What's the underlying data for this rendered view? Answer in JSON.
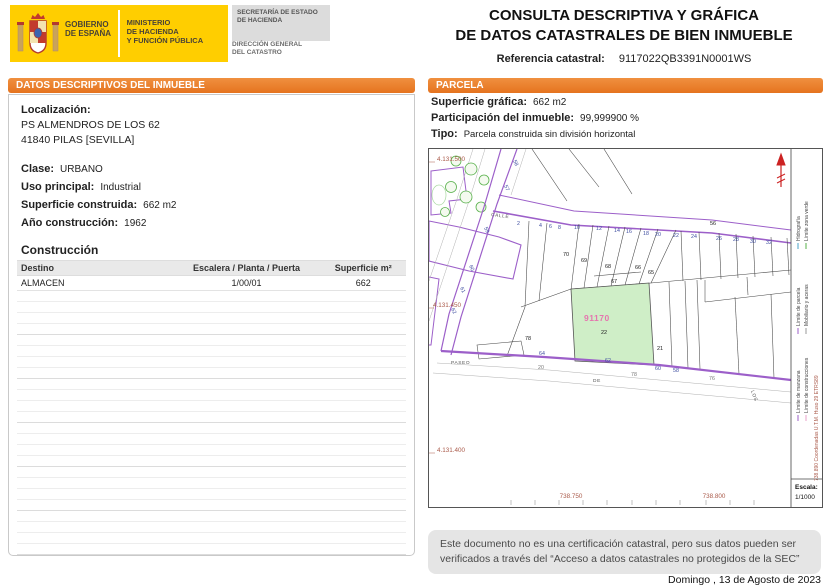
{
  "colors": {
    "banner_orange": "#e5731f",
    "logo_yellow": "#ffce00",
    "map_purple": "#9c5fc9",
    "parcel_green_fill": "#cfeec7",
    "highlight_pink": "#e575ae",
    "geo_red": "#aa5a4a"
  },
  "header": {
    "logo": {
      "gobierno_l1": "GOBIERNO",
      "gobierno_l2": "DE ESPAÑA",
      "ministerio_l1": "MINISTERIO",
      "ministerio_l2": "DE HACIENDA",
      "ministerio_l3": "Y FUNCIÓN PÚBLICA",
      "secretaria_l1": "SECRETARÍA DE ESTADO",
      "secretaria_l2": "DE HACIENDA",
      "direccion_l1": "DIRECCIÓN GENERAL",
      "direccion_l2": "DEL CATASTRO"
    },
    "title_line1": "CONSULTA DESCRIPTIVA Y GRÁFICA",
    "title_line2": "DE DATOS CATASTRALES DE BIEN INMUEBLE",
    "ref_label": "Referencia catastral:",
    "ref_value": "9117022QB3391N0001WS"
  },
  "left_panel": {
    "header": "DATOS DESCRIPTIVOS DEL INMUEBLE",
    "localizacion_label": "Localización:",
    "address_line1": "PS ALMENDROS DE LOS 62",
    "address_line2": "41840 PILAS [SEVILLA]",
    "fields": [
      {
        "label": "Clase:",
        "value": "URBANO"
      },
      {
        "label": "Uso principal:",
        "value": "Industrial"
      },
      {
        "label": "Superficie construida:",
        "value": "662 m2"
      },
      {
        "label": "Año construcción:",
        "value": "1962"
      }
    ],
    "construccion": {
      "title": "Construcción",
      "columns": [
        "Destino",
        "Escalera / Planta / Puerta",
        "Superficie m²"
      ],
      "rows": [
        [
          "ALMACEN",
          "1/00/01",
          "662"
        ]
      ]
    }
  },
  "right_panel": {
    "header": "PARCELA",
    "fields": [
      {
        "label": "Superficie gráfica:",
        "value": "662 m2"
      },
      {
        "label": "Participación del inmueble:",
        "value": "99,999900 %"
      },
      {
        "label": "Tipo:",
        "value": "Parcela construida sin división horizontal"
      }
    ],
    "map": {
      "geo": [
        "4.131.500",
        "4.131.450",
        "4.131.400"
      ],
      "xticks": [
        "738.750",
        "738.800"
      ],
      "utm": "738.890 Coordenadas U.T.M. Huso 29 ETRS89",
      "escala_label": "Escala:",
      "escala_value": "1/1000",
      "legend": [
        "Hidrografía",
        "Límite zona verde",
        "Límite de parcela",
        "Mobiliario y aceras",
        "Límite de manzana",
        "Límite de construcciones"
      ],
      "streets": {
        "calle": "CALLE",
        "paseo": "PASEO",
        "de": "DE",
        "los": "LOS"
      },
      "parcel_highlight": {
        "ref": "91170",
        "num": "22"
      },
      "parcels": [
        "70",
        "69",
        "68",
        "67",
        "66",
        "65",
        "21",
        "78",
        "56"
      ],
      "portals_calle": [
        "2",
        "4",
        "6",
        "8",
        "10",
        "12",
        "14",
        "16",
        "18",
        "20",
        "22",
        "24",
        "26",
        "28",
        "30",
        "32"
      ],
      "portals_diag": [
        "58",
        "57",
        "59",
        "60",
        "61",
        "62"
      ],
      "portals_paseo": [
        "64",
        "62",
        "60",
        "58",
        "20",
        "78",
        "76"
      ]
    }
  },
  "footer": {
    "disclaimer": "Este documento no es una certificación catastral, pero sus datos pueden ser verificados a través del “Acceso a datos catastrales no protegidos de la SEC”",
    "date": "Domingo , 13 de Agosto de 2023"
  }
}
